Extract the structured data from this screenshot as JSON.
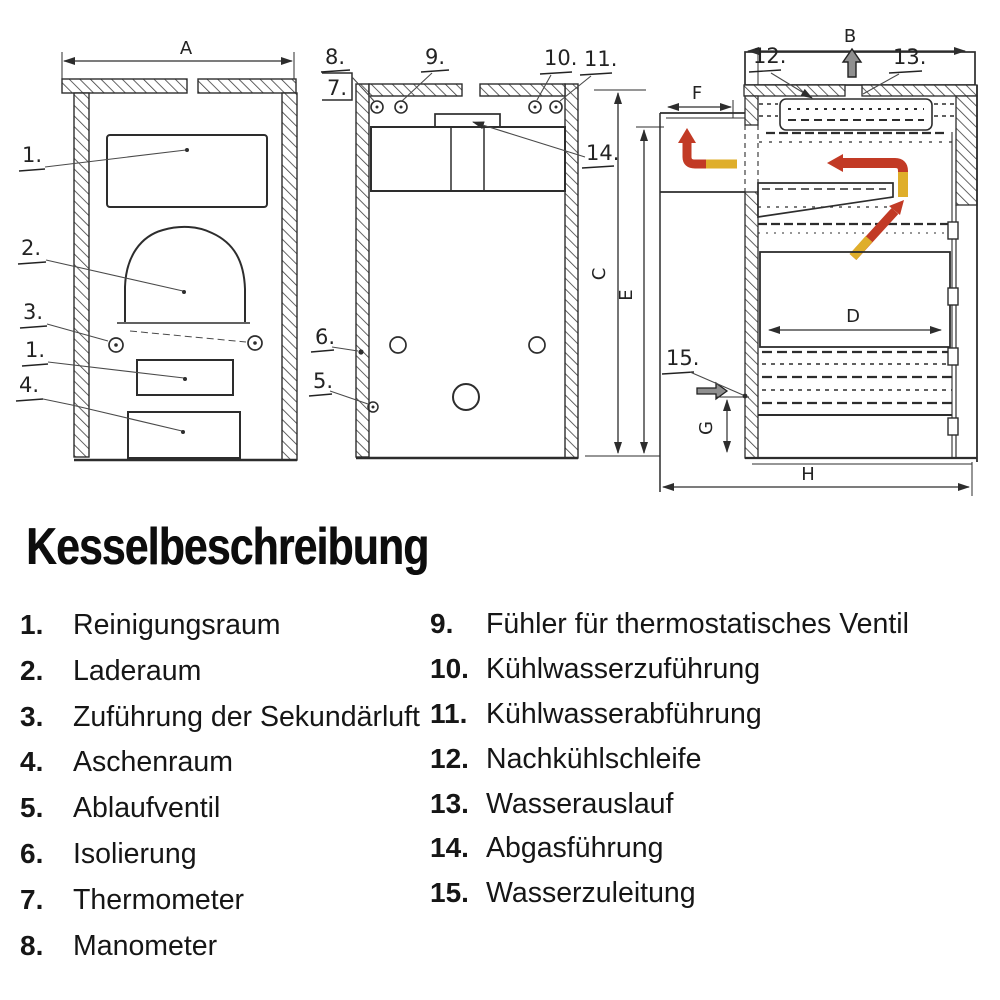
{
  "heading": {
    "title": "Kesselbeschreibung"
  },
  "legend": {
    "left": [
      {
        "num": "1.",
        "label": "Reinigungsraum"
      },
      {
        "num": "2.",
        "label": "Laderaum"
      },
      {
        "num": "3.",
        "label": "Zuführung der Sekundärluft"
      },
      {
        "num": "4.",
        "label": "Aschenraum"
      },
      {
        "num": "5.",
        "label": "Ablaufventil"
      },
      {
        "num": "6.",
        "label": "Isolierung"
      },
      {
        "num": "7.",
        "label": "Thermometer"
      },
      {
        "num": "8.",
        "label": "Manometer"
      }
    ],
    "right": [
      {
        "num": "9.",
        "label": "Fühler für thermostatisches Ventil"
      },
      {
        "num": "10.",
        "label": "Kühlwasserzuführung"
      },
      {
        "num": "11.",
        "label": "Kühlwasserabführung"
      },
      {
        "num": "12.",
        "label": "Nachkühlschleife"
      },
      {
        "num": "13.",
        "label": "Wasserauslauf"
      },
      {
        "num": "14.",
        "label": "Abgasführung"
      },
      {
        "num": "15.",
        "label": "Wasserzuleitung"
      }
    ]
  },
  "diagram": {
    "dims": {
      "A": "A",
      "B": "B",
      "C": "C",
      "D": "D",
      "E": "E",
      "F": "F",
      "G": "G",
      "H": "H"
    },
    "front_view": {
      "callouts": {
        "c1": "1.",
        "c2": "2.",
        "c3": "3.",
        "c1b": "1.",
        "c4": "4."
      }
    },
    "middle_view": {
      "callouts": {
        "c8": "8.",
        "c7": "7.",
        "c9": "9.",
        "c10": "10.",
        "c11": "11.",
        "c14": "14.",
        "c6": "6.",
        "c5": "5."
      }
    },
    "side_view": {
      "callouts": {
        "c12": "12.",
        "c13": "13.",
        "c15": "15."
      }
    },
    "colors": {
      "ink": "#2d2d2d",
      "flow_hot": "#c23a25",
      "flow_warm": "#dfae2a",
      "smoke_gray": "#8f8f8f"
    }
  }
}
